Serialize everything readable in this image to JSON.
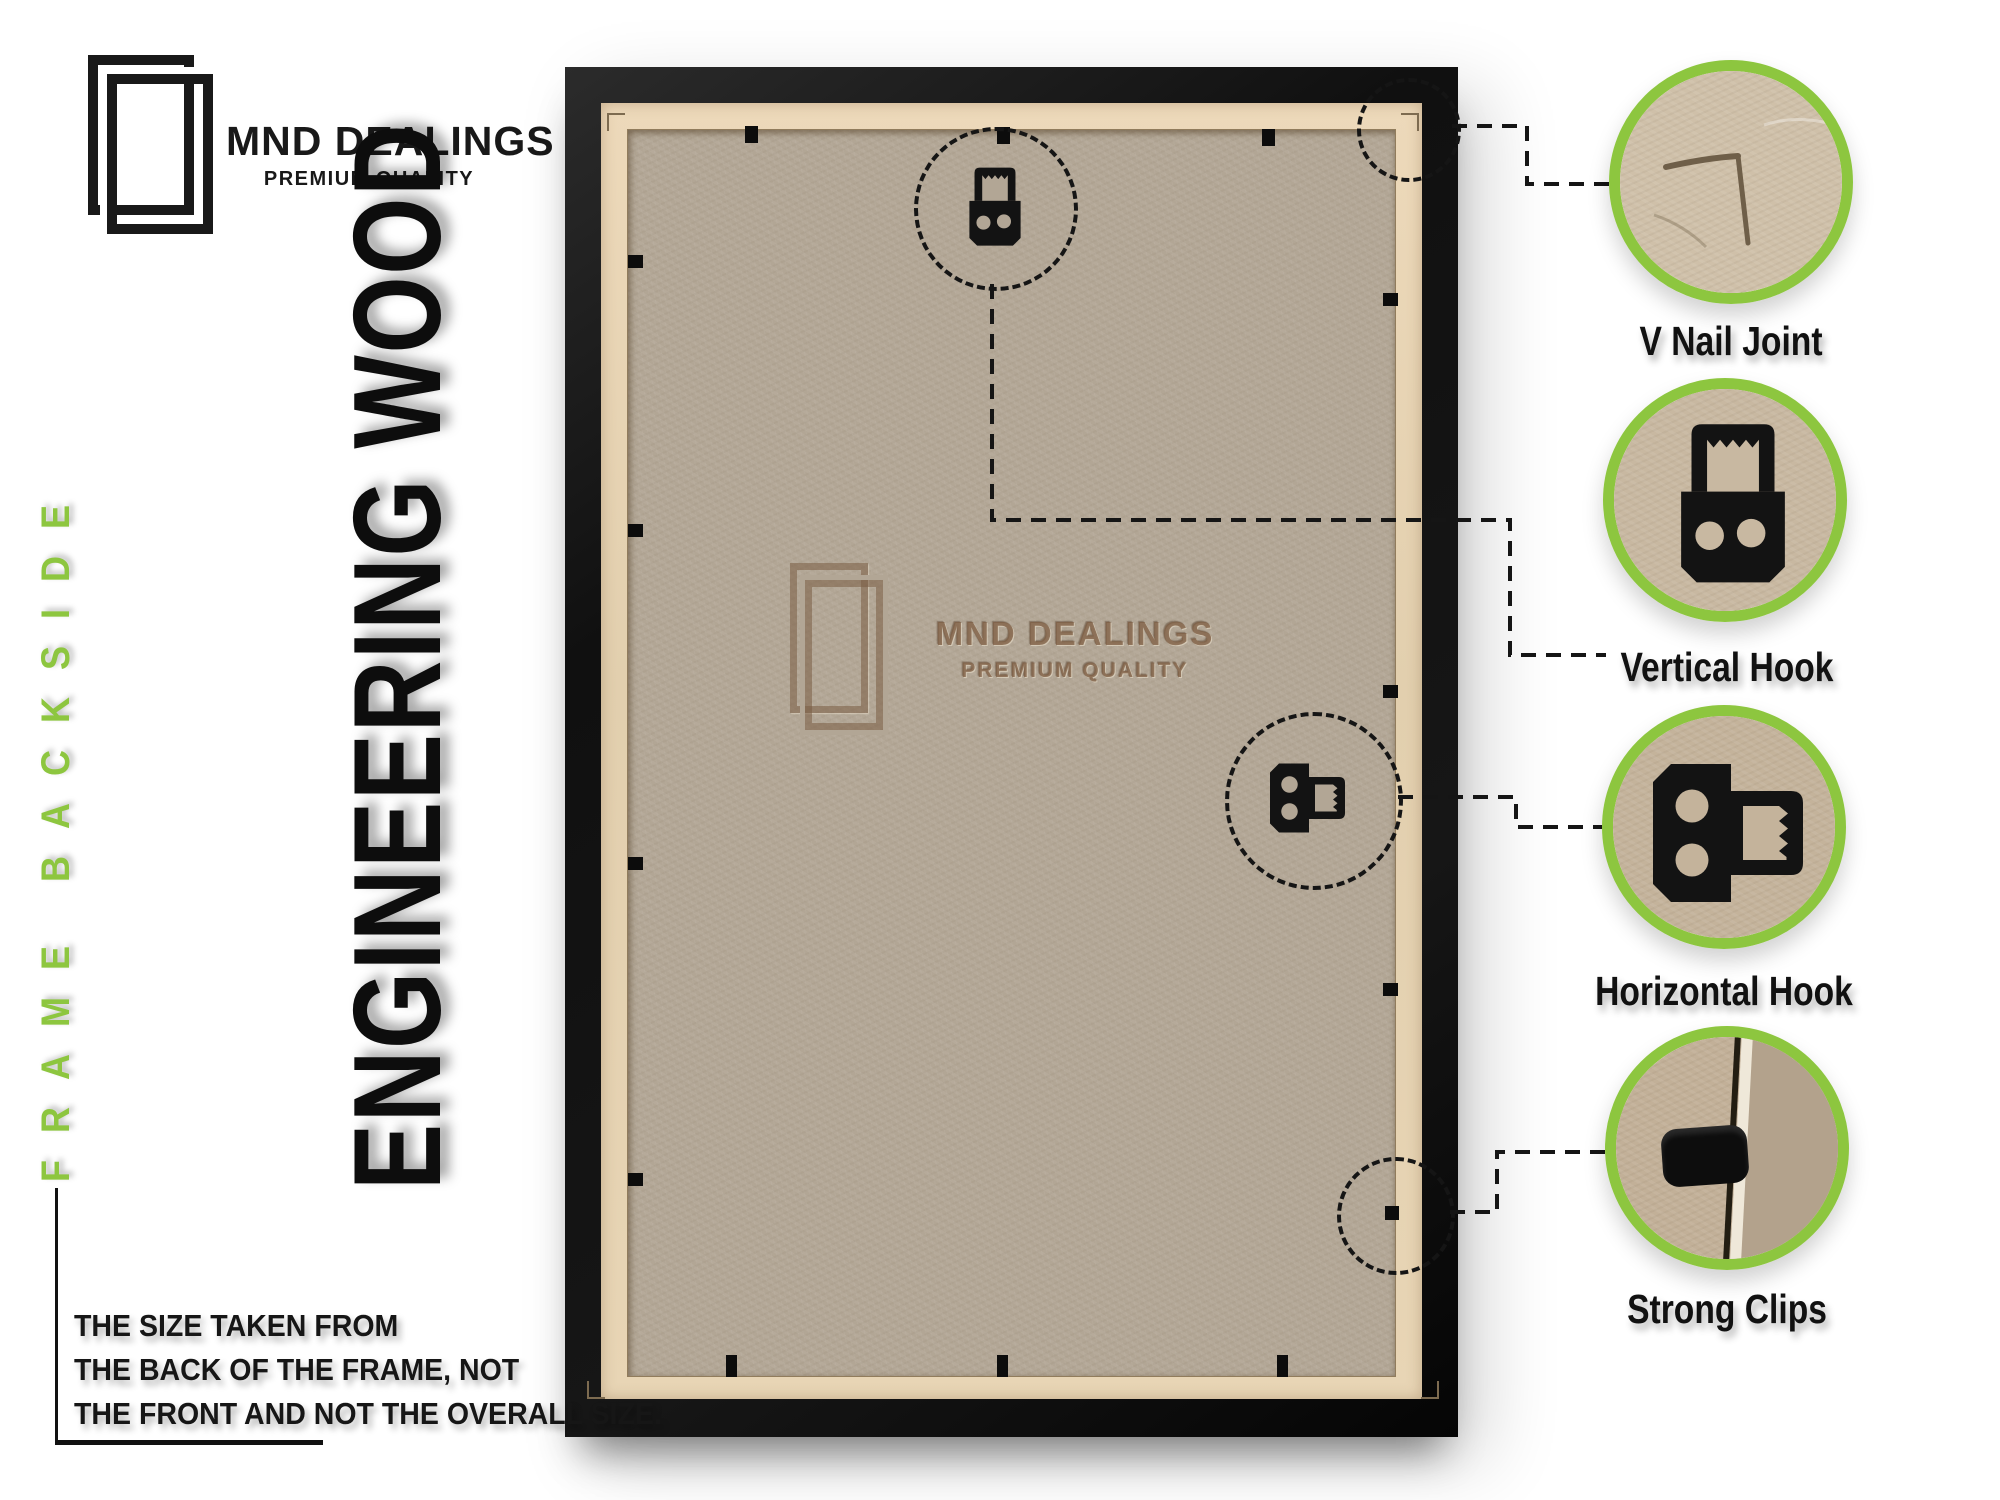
{
  "header": {
    "brand": "MND DEALINGS",
    "tagline": "PREMIUM QUALITY",
    "logo_icon": "double-frame-icon"
  },
  "left_rail": {
    "side_text": "FRAME BACKSIDE",
    "material_text": "ENGINEERING WOOD"
  },
  "photo": {
    "watermark_brand": "MND DEALINGS",
    "watermark_tagline": "PREMIUM QUALITY"
  },
  "callouts": [
    {
      "label": "V Nail Joint",
      "icon": "v-nail-joint-photo"
    },
    {
      "label": "Vertical Hook",
      "icon": "vertical-hook-photo"
    },
    {
      "label": "Horizontal Hook",
      "icon": "horizontal-hook-photo"
    },
    {
      "label": "Strong Clips",
      "icon": "strong-clip-photo"
    }
  ],
  "footnote": {
    "lines": [
      "THE SIZE TAKEN FROM",
      "THE BACK OF THE FRAME, NOT",
      "THE FRONT AND NOT THE OVERALL SIZE."
    ]
  },
  "colors": {
    "accent_green": "#8dc63f",
    "frame_black": "#151515",
    "mdf_board": "#b2a695",
    "plywood_edge": "#e4d2b2",
    "watermark_brown": "#806046"
  }
}
